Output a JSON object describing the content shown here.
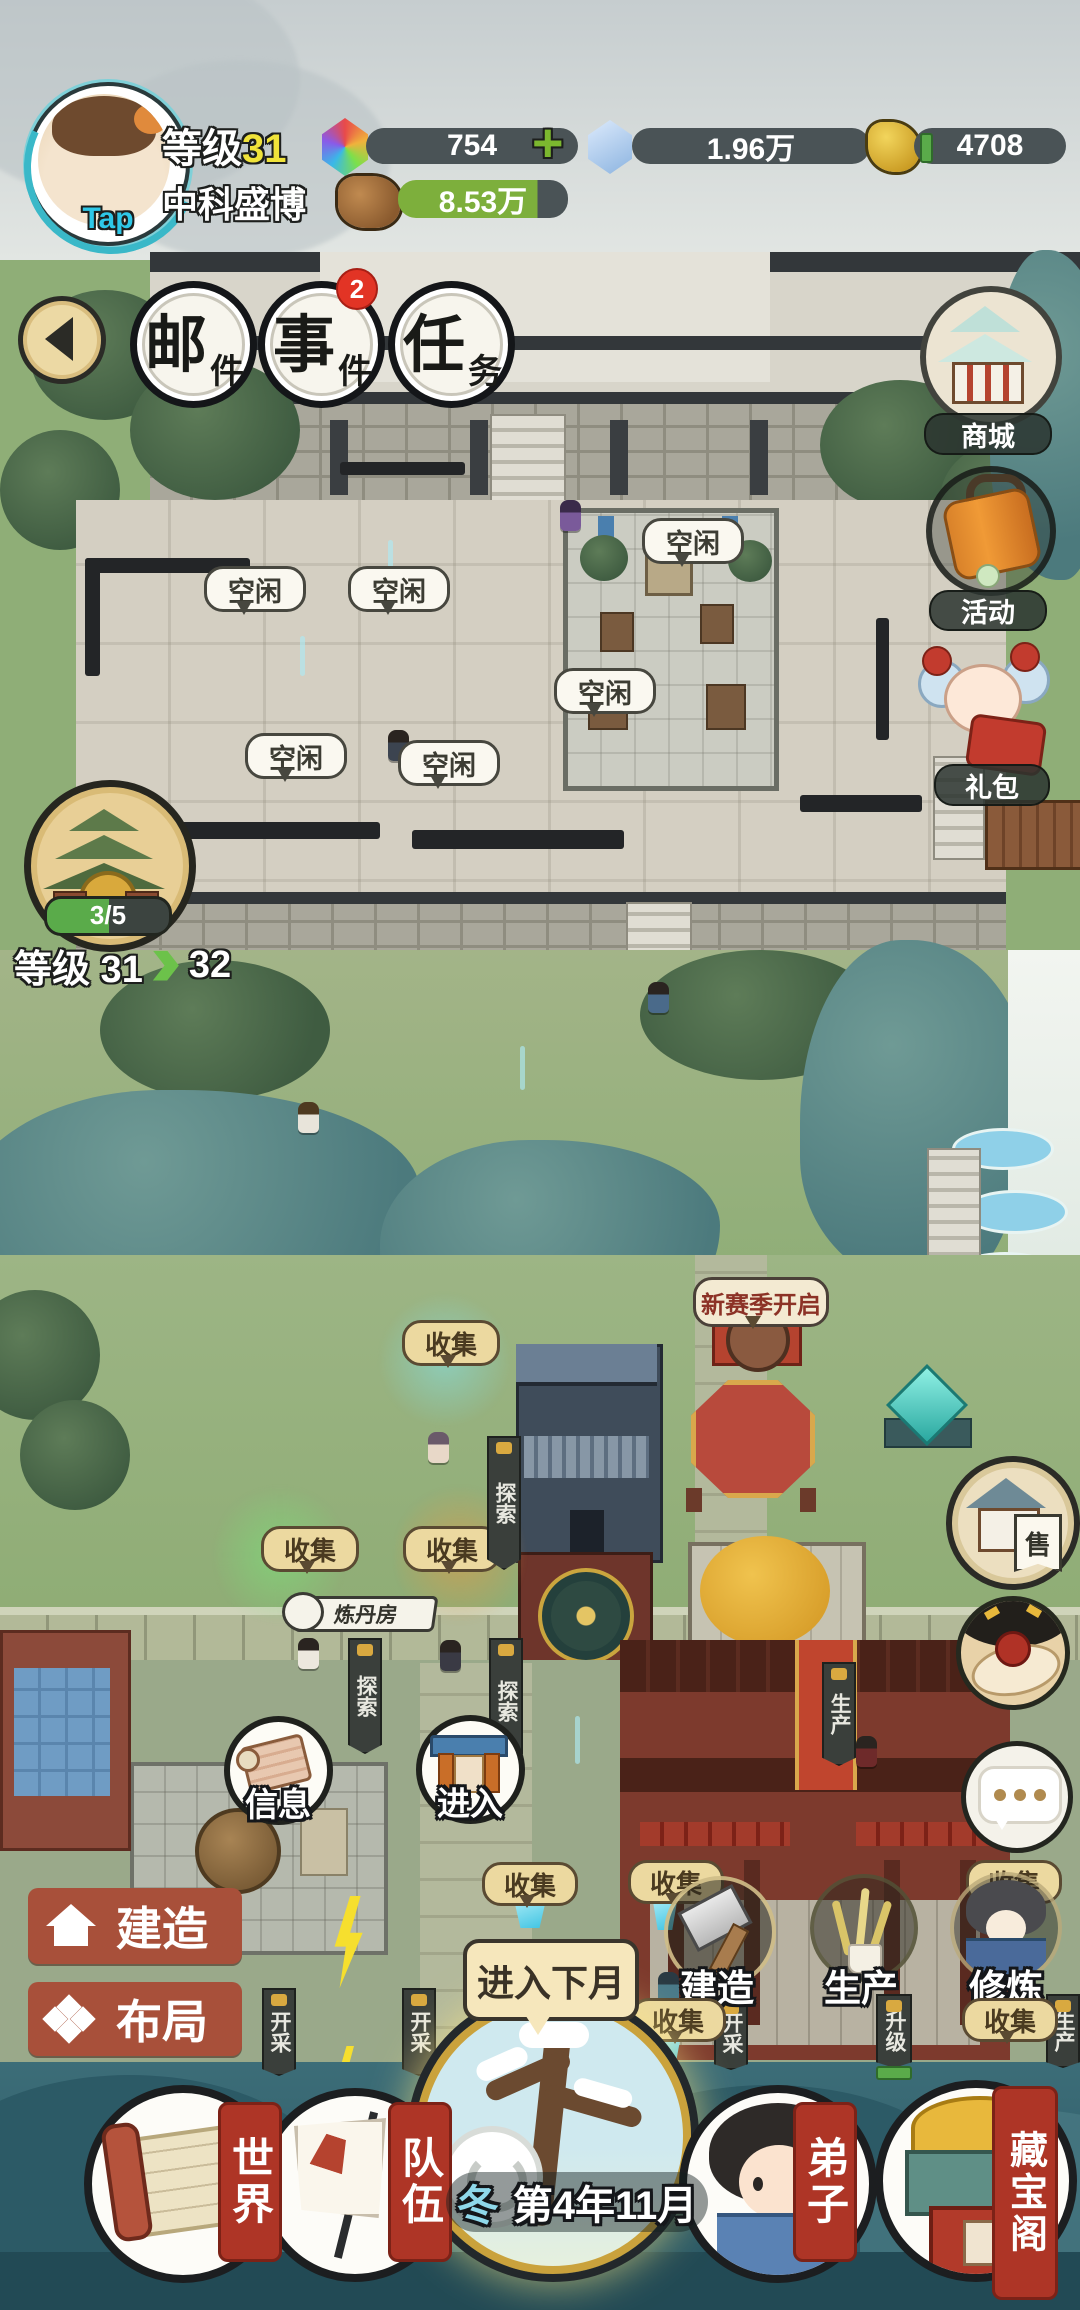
{
  "header": {
    "tap": "Tap",
    "level_label": "等级",
    "level_value": "31",
    "player_name": "中科盛博",
    "gem_value": "754",
    "plus": "+",
    "crystal_value": "1.96万",
    "gold_value": "4708",
    "wood_value": "8.53万"
  },
  "top_menu": {
    "mail_big": "邮",
    "mail_small": "件",
    "event_big": "事",
    "event_small": "件",
    "event_badge": "2",
    "task_big": "任",
    "task_small": "务"
  },
  "right_menu": {
    "shop": "商城",
    "activity": "活动",
    "gift": "礼包"
  },
  "sect": {
    "progress": "3/5",
    "level_prefix": "等级 31",
    "level_next": "32"
  },
  "labels": {
    "idle": "空闲",
    "collect": "收集",
    "explore": "探索",
    "season_banner": "新赛季开启",
    "alchemy_room": "炼丹房",
    "produce": "生产",
    "mine": "开采",
    "upgrade": "升级",
    "sell": "售"
  },
  "mid_buttons": {
    "info": "信息",
    "enter": "进入"
  },
  "bottom": {
    "build_menu": "建造",
    "layout_menu": "布局",
    "next_month": "进入下月",
    "action_build": "建造",
    "action_produce": "生产",
    "action_train": "修炼",
    "nav_world": "世界",
    "nav_team": "队伍",
    "nav_disciple": "弟子",
    "nav_treasure": "藏宝阁",
    "season": "冬",
    "date": "第4年11月"
  }
}
